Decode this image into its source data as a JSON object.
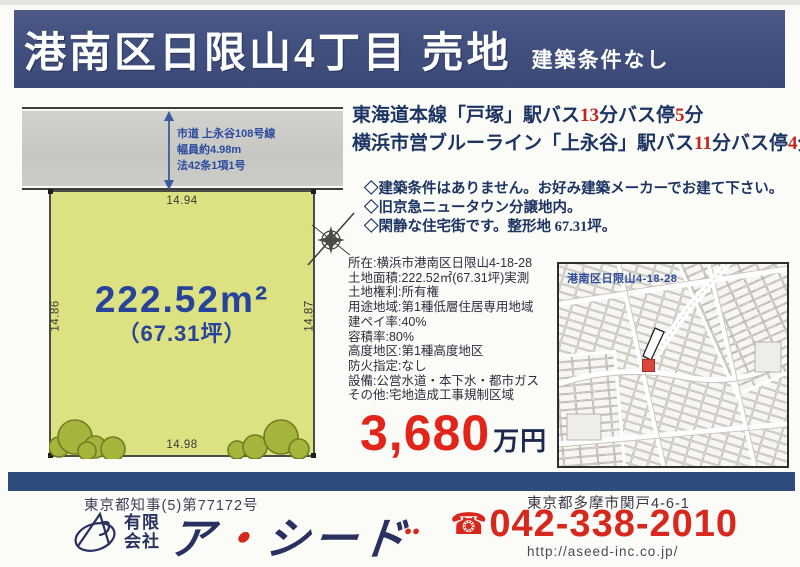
{
  "colors": {
    "header_navy": "#3f4d7c",
    "text_navy": "#1c3462",
    "highlight_red": "#c3241c",
    "price_red": "#e1251b",
    "plot_fill": "#dce181",
    "footer_bar_navy": "#2e4d7c",
    "map_label_blue": "#2b4a9b"
  },
  "header": {
    "title": "港南区日限山4丁目 売地",
    "subtitle": "建築条件なし"
  },
  "plot_diagram": {
    "road": {
      "line1": "市道 上永谷108号線",
      "line2": "幅員約4.98m",
      "line3": "法42条1項1号"
    },
    "dimensions": {
      "top": "14.94",
      "bottom": "14.98",
      "left": "14.86",
      "right": "14.87"
    },
    "area_sqm": "222.52m²",
    "area_tsubo": "（67.31坪）"
  },
  "access": {
    "line1": {
      "t1": "東海道本線「戸塚」駅バス",
      "n1": "13",
      "t2": "分バス停",
      "n2": "5",
      "t3": "分"
    },
    "line2": {
      "t1": "横浜市営ブルーライン「上永谷」駅バス",
      "n1": "11",
      "t2": "分バス停",
      "n2": "4",
      "t3": "分"
    }
  },
  "features": [
    "◇建築条件はありません。お好み建築メーカーでお建て下さい。",
    "◇旧京急ニュータウン分譲地内。",
    "◇閑静な住宅街です。整形地 67.31坪。"
  ],
  "details": [
    "所在:横浜市港南区日限山4-18-28",
    "土地面積:222.52㎡(67.31坪)実測",
    "土地権利:所有権",
    "用途地域:第1種低層住居専用地域",
    "建ペイ率:40%",
    "容積率:80%",
    "高度地区:第1種高度地区",
    "防火指定:なし",
    "設備:公営水道・本下水・都市ガス",
    "その他:宅地造成工事規制区域"
  ],
  "price": {
    "amount": "3,680",
    "unit": "万円"
  },
  "map": {
    "label": "港南区日限山4-18-28"
  },
  "footer": {
    "license": "東京都知事(5)第77172号",
    "company_type_line1": "有限",
    "company_type_line2": "会社",
    "company_name_a": "ア",
    "company_name_dot": "・",
    "company_name_rest": "シード",
    "company_name_dots": "••",
    "address": "東京都多摩市関戸4-6-1",
    "phone_icon": "☎",
    "phone": "042-338-2010",
    "url": "http://aseed-inc.co.jp/"
  }
}
